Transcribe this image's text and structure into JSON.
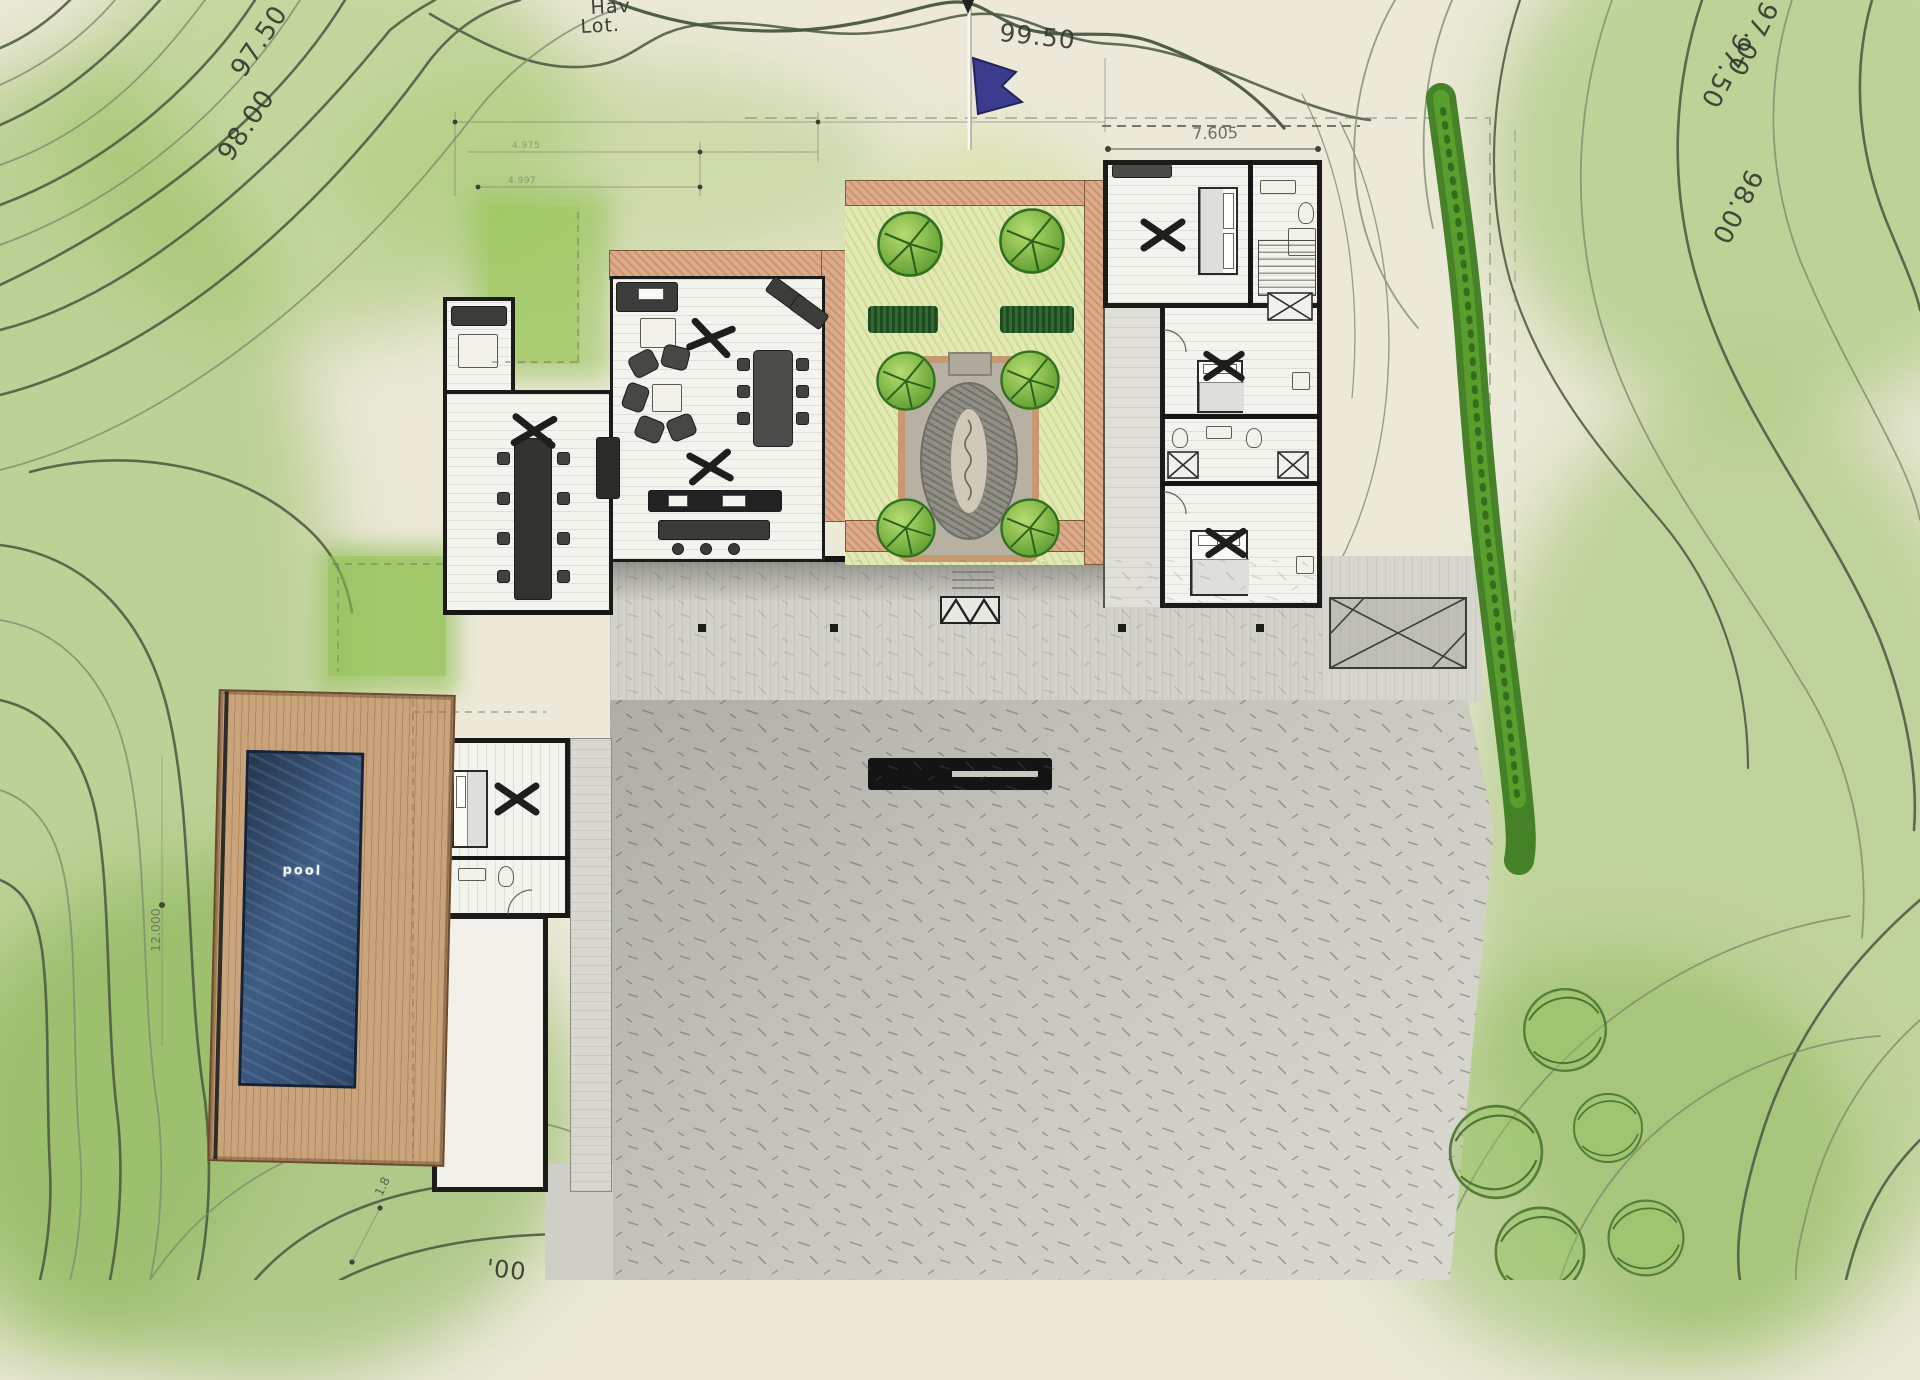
{
  "title": "Hand-drawn architectural site plan with topographic contours",
  "colors": {
    "paper": "#ece9d8",
    "wash_green": "#9cc161",
    "contour_dark": "#49563f",
    "contour_light": "#7e8d6d",
    "wall_black": "#1b1b19",
    "terracotta": "#dcab8a",
    "pool_blue": "#31486b",
    "deck_tan": "#c9a379",
    "hedge_green": "#3e7c21",
    "tree_green": "#5ea02e",
    "terrace_gray": "#c2c2ba",
    "flag_blue": "#3c3c8e"
  },
  "site": {
    "lot_label": {
      "line1": "Hav",
      "line2": "Lot."
    },
    "marker": "survey-flag",
    "contour_labels": {
      "top_left": [
        "97.50",
        "98.00"
      ],
      "ridge": "99.50",
      "top_right": [
        "97.00",
        "97.50",
        "98.00"
      ],
      "bottom_partial": "'00"
    }
  },
  "plan": {
    "pool_label": "pool",
    "dimensions": {
      "right_wing_width": "7.605",
      "pool_length": "12.000",
      "north": [
        "4.975",
        "4.997"
      ],
      "deck": "1.8"
    }
  }
}
